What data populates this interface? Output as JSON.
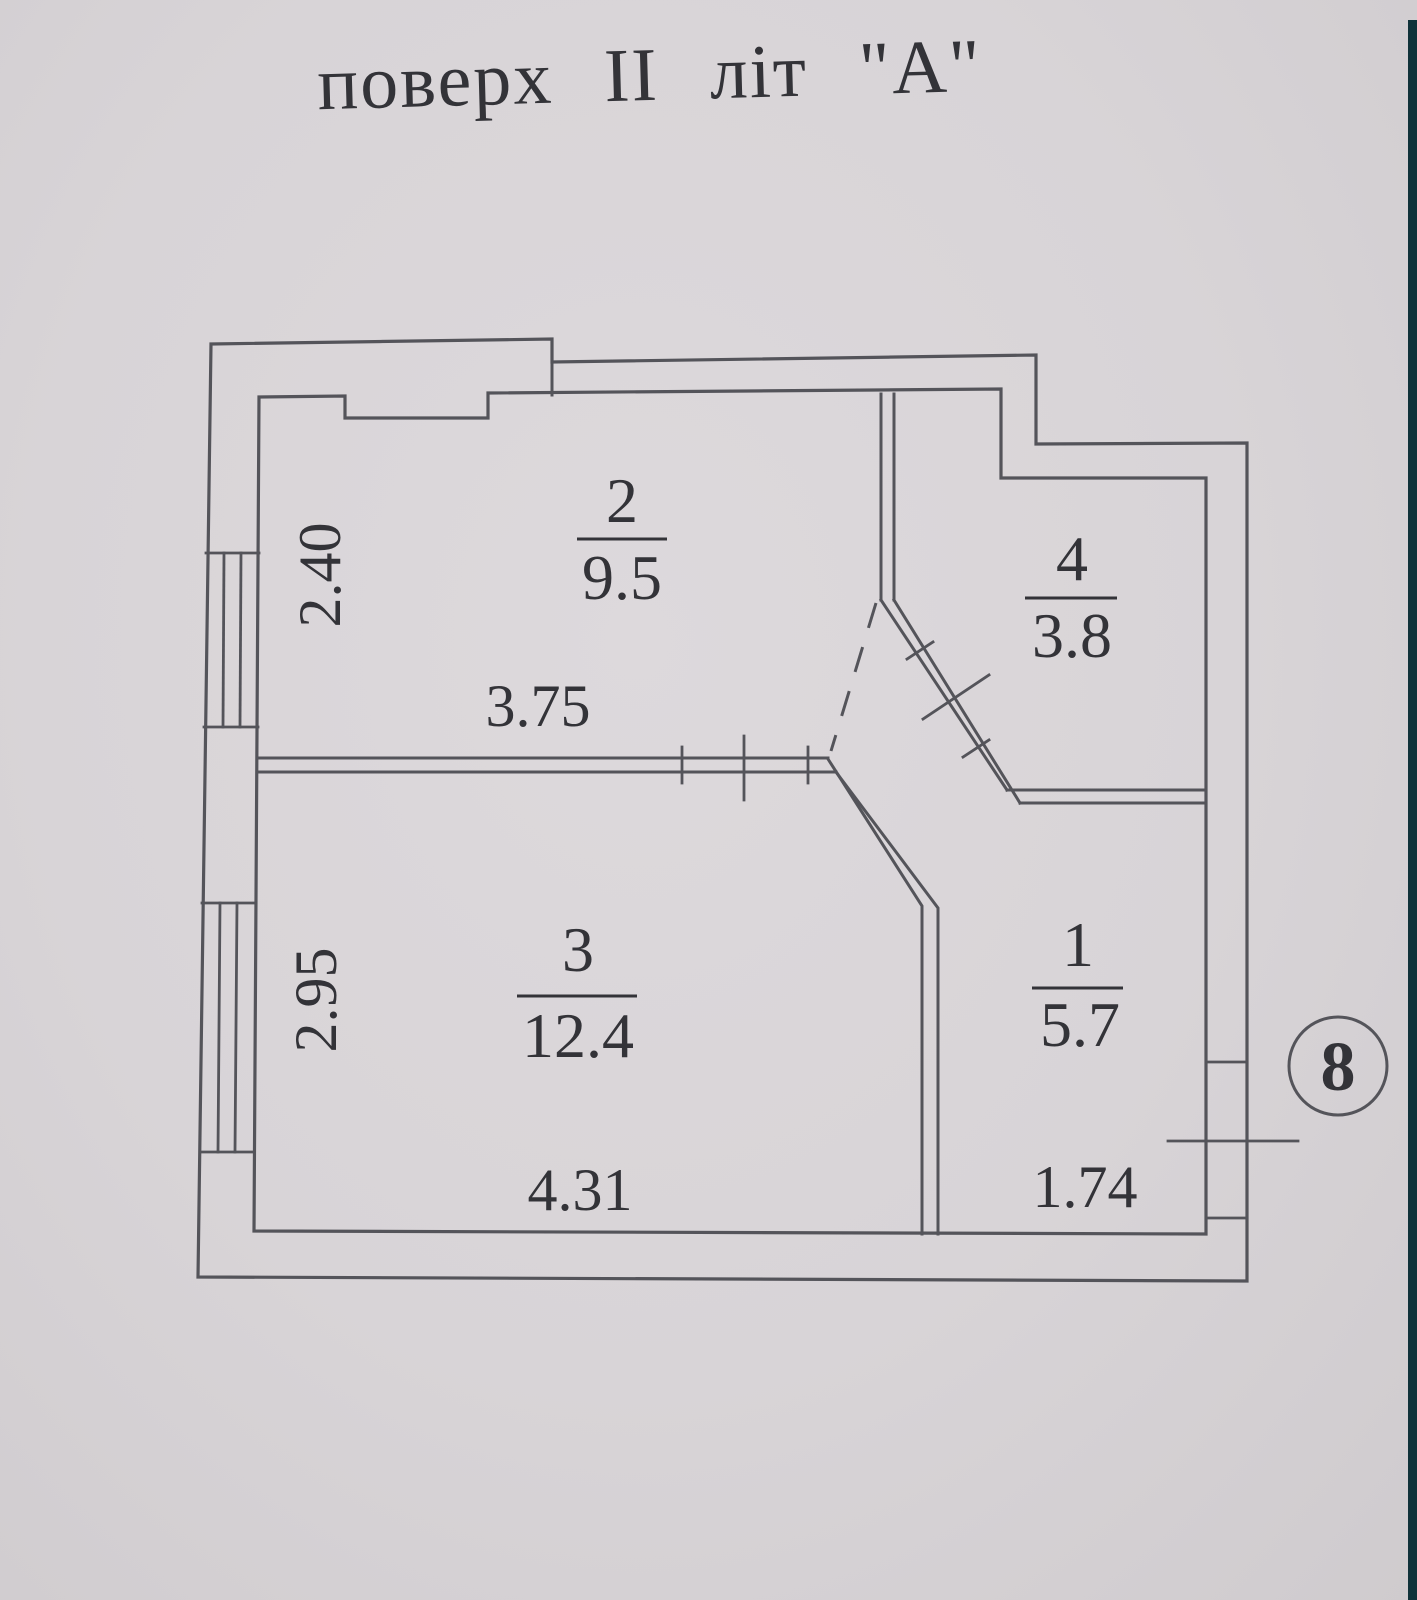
{
  "title": "поверх II літ \"А\"",
  "floor_plan": {
    "rooms": [
      {
        "number": "2",
        "area": "9.5"
      },
      {
        "number": "4",
        "area": "3.8"
      },
      {
        "number": "3",
        "area": "12.4"
      },
      {
        "number": "1",
        "area": "5.7"
      }
    ],
    "dimensions": {
      "room_2_width": "3.75",
      "room_2_depth": "2.40",
      "room_3_width": "4.31",
      "room_3_depth": "2.95",
      "room_1_width": "1.74"
    },
    "axis_marker": "8"
  },
  "colors": {
    "paper": "#d8d4d7",
    "ink_line": "#54545a",
    "ink_text": "#333338",
    "edge_band": "#10323a"
  }
}
